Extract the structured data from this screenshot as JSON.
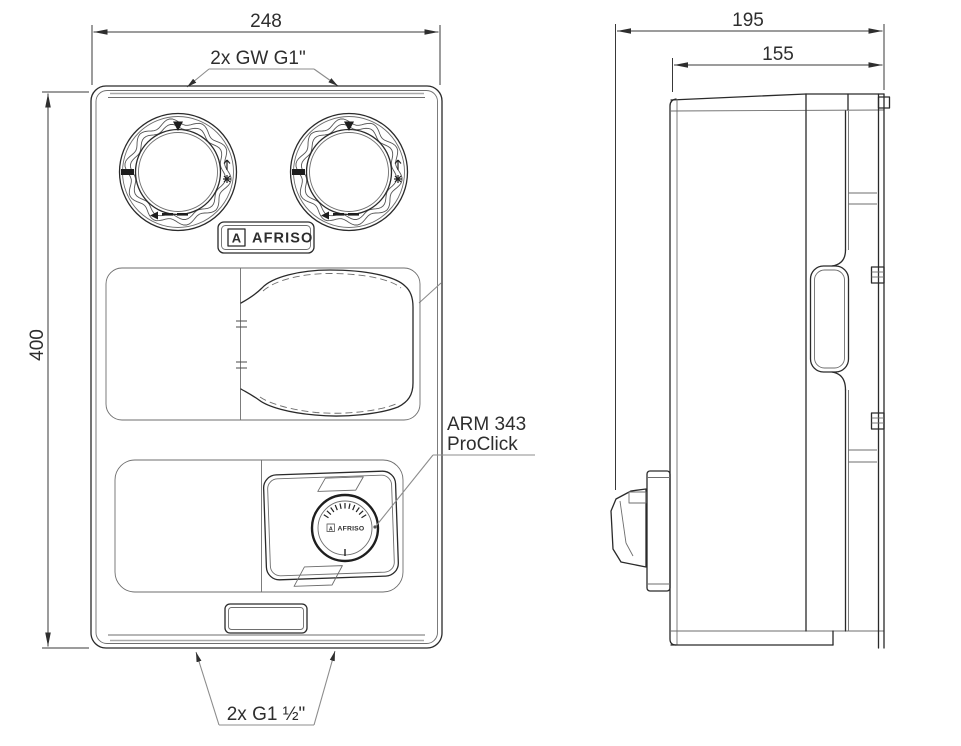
{
  "front_view": {
    "dim_width": "248",
    "dim_height": "400",
    "label_top_connections": "2x GW G1\"",
    "label_bottom_connections": "2x G1 ½\"",
    "actuator_label_line1": "ARM 343",
    "actuator_label_line2": "ProClick",
    "badge": {
      "letter": "A",
      "brand": "AFRISO"
    },
    "knob": {
      "letter": "A",
      "brand": "AFRISO"
    }
  },
  "side_view": {
    "dim_depth_total": "195",
    "dim_depth_housing": "155"
  },
  "colors": {
    "main_line": "#2a2a2a",
    "soft_line": "#a9a9a9",
    "text": "#2e2e2e",
    "background": "#ffffff"
  }
}
